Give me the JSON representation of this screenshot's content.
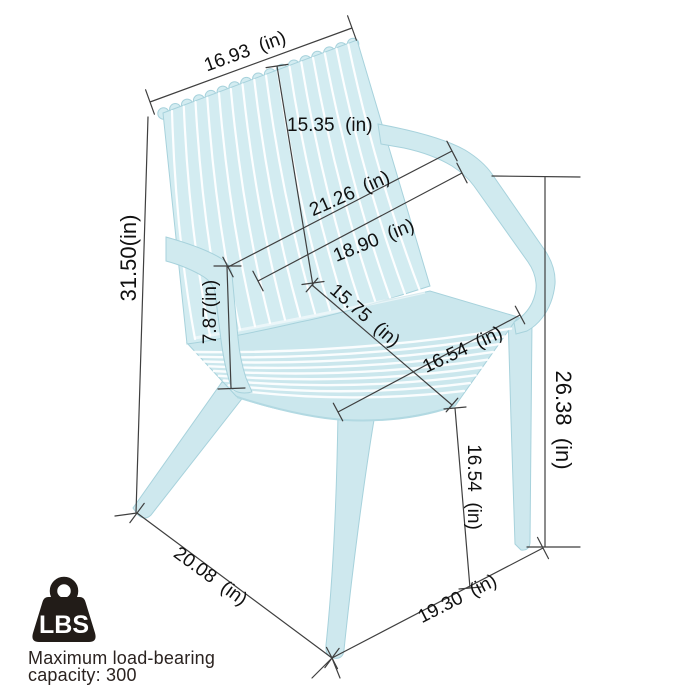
{
  "colors": {
    "chair_base": "#cfe9ee",
    "chair_backrest": "#d3ecf1",
    "chair_seat": "#cbe7ed",
    "chair_edge": "#a7d2dc",
    "dimension_line": "#3f3f3f",
    "label_text": "#101010",
    "icon_black": "#221c18",
    "background": "#ffffff"
  },
  "dims": [
    {
      "id": "top-width",
      "label": "16.93  (in)"
    },
    {
      "id": "back-height",
      "label": "15.35  (in)"
    },
    {
      "id": "overall-width",
      "label": "21.26  (in)"
    },
    {
      "id": "inner-width",
      "label": "18.90  (in)"
    },
    {
      "id": "overall-height",
      "label": "31.50(in)"
    },
    {
      "id": "armrest-height",
      "label": "7.87(in)"
    },
    {
      "id": "seat-depth",
      "label": "15.75  (in)"
    },
    {
      "id": "seat-width",
      "label": "16.54  (in)"
    },
    {
      "id": "armrest-to-floor",
      "label": "26.38  (in)"
    },
    {
      "id": "seat-height",
      "label": "16.54  (in)"
    },
    {
      "id": "base-depth",
      "label": "20.08  (in)"
    },
    {
      "id": "base-width",
      "label": "19.30  (in)"
    }
  ],
  "load_badge": {
    "icon_label": "LBS",
    "caption_line1": "Maximum load-bearing",
    "caption_line2": "capacity: 300"
  }
}
